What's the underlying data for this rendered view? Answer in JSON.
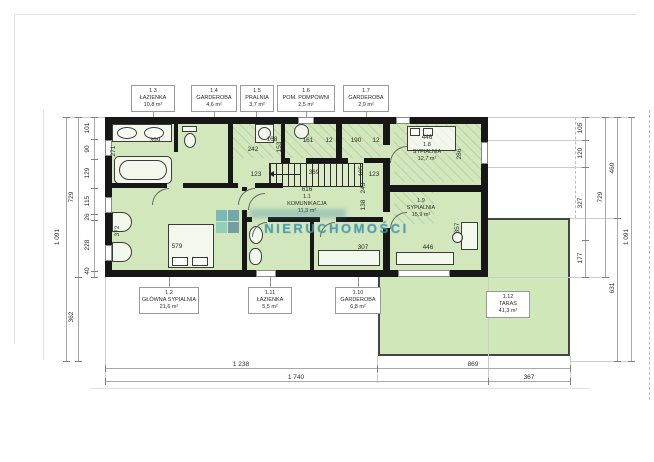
{
  "watermark": {
    "brand": "NIERUCHOMOŚCI"
  },
  "labels": {
    "t13": {
      "id": "1.3",
      "name": "ŁAZIENKA",
      "area": "10,8 m²"
    },
    "t14": {
      "id": "1.4",
      "name": "GARDEROBA",
      "area": "4,6 m²"
    },
    "t15": {
      "id": "1.5",
      "name": "PRALNIA",
      "area": "3,7 m²"
    },
    "t16": {
      "id": "1.6",
      "name": "POM. POMPOWNI",
      "area": "2,5 m²"
    },
    "t17": {
      "id": "1.7",
      "name": "GARDEROBA",
      "area": "2,9 m²"
    },
    "b12": {
      "id": "1.2",
      "name": "GŁÓWNA SYPIALNIA",
      "area": "21,6 m²"
    },
    "b111": {
      "id": "1.11",
      "name": "ŁAZIENKA",
      "area": "5,5 m²"
    },
    "b110": {
      "id": "1.10",
      "name": "GARDEROBA",
      "area": "6,8 m²"
    },
    "r18": {
      "id": "1.8",
      "name": "SYPIALNIA",
      "area": "12,7 m²"
    },
    "r11": {
      "id": "1.1",
      "name": "KOMUNIKACJA",
      "area": "11,3 m²"
    },
    "r19": {
      "id": "1.9",
      "name": "SYPIALNIA",
      "area": "15,9 m²"
    },
    "taras": {
      "id": "1.12",
      "name": "TARAS",
      "area": "41,3 m²"
    }
  },
  "dims": {
    "lc": [
      "101",
      "90",
      "129",
      "115",
      "26",
      "228",
      "40"
    ],
    "lt": {
      "t729": "729",
      "t1091": "1 091",
      "t362": "362"
    },
    "rc": [
      "105",
      "120",
      "327",
      "177"
    ],
    "rt": {
      "t460": "460",
      "t729": "729",
      "t631": "631",
      "t1091": "1 091"
    },
    "bt": {
      "b1238": "1 238",
      "b869": "869",
      "b1740": "1 740",
      "b367": "367"
    },
    "in": {
      "i399": "399",
      "i271": "271",
      "i168": "168",
      "i242": "242",
      "i153": "153",
      "i161": "161",
      "i12a": "12",
      "i190": "190",
      "i12b": "12",
      "i446top": "446",
      "i286": "286",
      "i123l": "123",
      "i369": "369",
      "i105": "105",
      "i123r": "123",
      "i616": "616",
      "i243": "243",
      "i138": "138",
      "i372": "372",
      "i579": "579",
      "i307": "307",
      "i446b": "446",
      "i357": "357"
    }
  }
}
